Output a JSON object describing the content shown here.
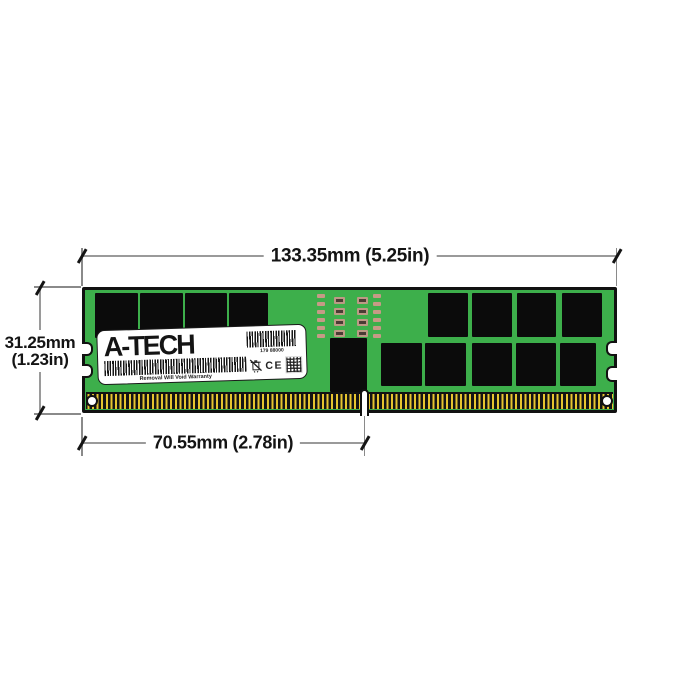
{
  "product_diagram": {
    "title": "Registered DDR memory module dimensional drawing",
    "dimensions": {
      "width": "133.35mm (5.25in)",
      "height_line1": "31.25mm",
      "height_line2": "(1.23in)",
      "pin_offset": "70.55mm (2.78in)"
    },
    "module": {
      "label": {
        "brand": "A-TECH",
        "serial": "179 88000",
        "warranty": "Removal Will Void Warranty",
        "ce_mark": "CE"
      }
    },
    "colors": {
      "pcb_green": "#3DAF4B",
      "chip_black": "#0B0B0B",
      "pin_gold": "#E7C52F",
      "smd_tan": "#C79A86",
      "smd_dark": "#4A3C34",
      "dimension_line_gray": "#9A9A9A",
      "text_black": "#141414",
      "label_white": "#FFFFFF"
    }
  }
}
